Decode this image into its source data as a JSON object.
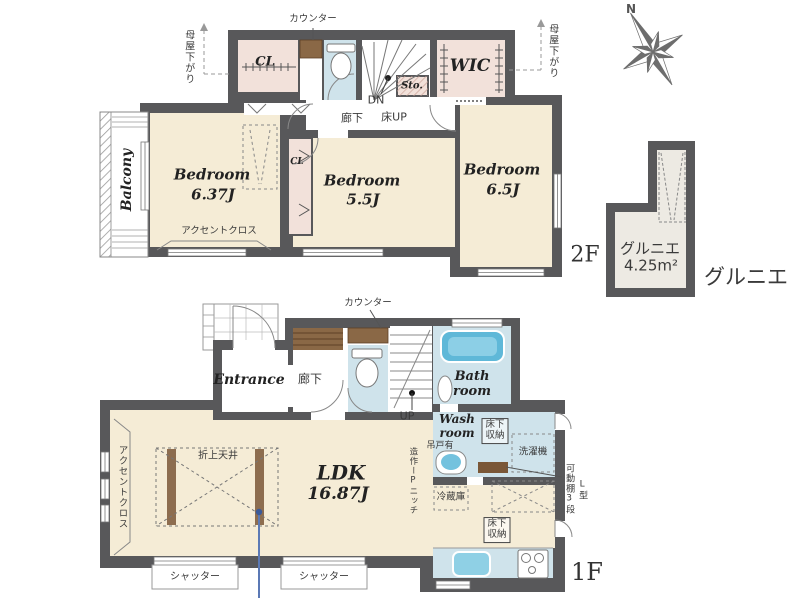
{
  "floor2": {
    "roof_note_left": "母屋下がり",
    "roof_note_right": "母屋下がり",
    "counter": "カウンター",
    "closet_top": "CL",
    "storage": "Sto.",
    "wic": "WIC",
    "down": "DN",
    "hallway": "廊下",
    "floor_up": "床UP",
    "balcony": "Balcony",
    "bedroom1": {
      "name": "Bedroom",
      "size": "6.37J"
    },
    "bedroom2": {
      "name": "Bedroom",
      "size": "5.5J"
    },
    "bedroom3": {
      "name": "Bedroom",
      "size": "6.5J"
    },
    "accent_wall": "アクセントクロス",
    "closet_mid": "CL",
    "floor_tag": "2F"
  },
  "loft": {
    "name": "グルニエ",
    "area": "4.25m²",
    "caption": "グルニエ"
  },
  "compass": {
    "north": "N"
  },
  "floor1": {
    "counter": "カウンター",
    "entrance": "Entrance",
    "hallway": "廊下",
    "up": "UP",
    "bath": "Bath room",
    "wash": "Wash room",
    "hanging_door": "吊戸有",
    "underfloor_storage_wash": "床下収納",
    "washing_machine": "洗濯機",
    "shelf_note": "可動棚3段",
    "shelf_type": "L型",
    "refrigerator": "冷蔵庫",
    "underfloor_storage_kitchen": "床下収納",
    "ldk": {
      "name": "LDK",
      "size": "16.87J"
    },
    "coffered_ceiling": "折上天井",
    "accent_wall": "アクセントクロス",
    "shutter_left": "シャッター",
    "shutter_right": "シャッター",
    "niche_note": "造作ーPニッチ",
    "floor_tag": "1F"
  },
  "colors": {
    "wall": "#58585a",
    "floor_cream": "#f5ecd6",
    "floor_pink": "#f2e1da",
    "floor_blue": "#cfe3eb",
    "fixture_blue": "#5fb8d8",
    "wood": "#8a6846",
    "marker_blue": "#5b79b5"
  }
}
